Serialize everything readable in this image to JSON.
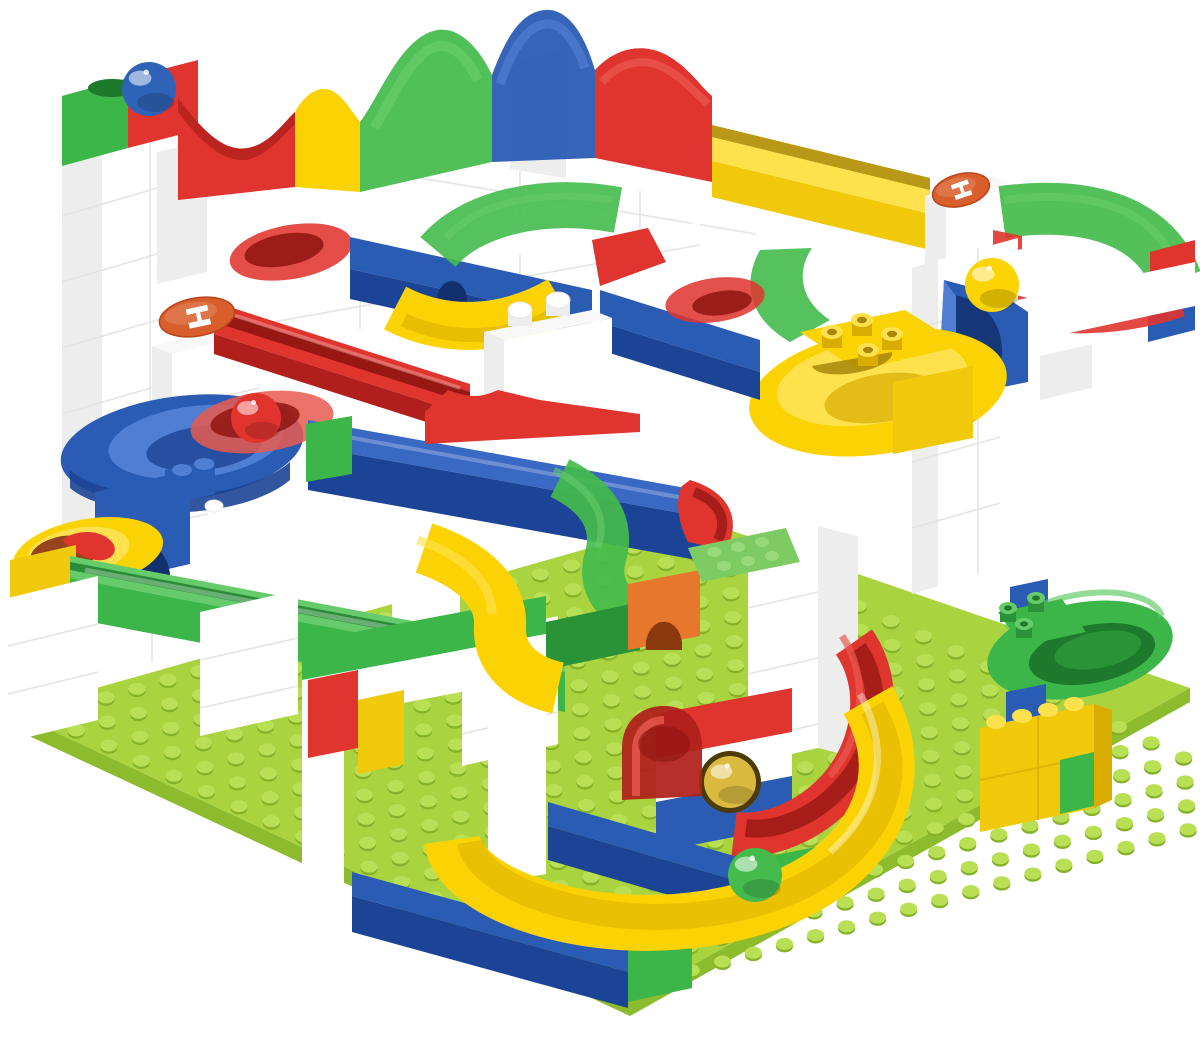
{
  "meta": {
    "alt": "Colorful marble run toy built from interlocking bricks on a lime-green baseplate, with red, blue, green and yellow chutes, white support towers and five marbles",
    "product_kind": "marble run construction set"
  },
  "brand": {
    "logo_letter": "H"
  },
  "palette": {
    "bg": "#ffffff",
    "white": "#ffffff",
    "white_side": "#ededed",
    "white_top": "#f8f8f8",
    "white_deep": "#dcdcdc",
    "seam": "#e4e4e4",
    "red": "#e0342f",
    "red_dark": "#b01f1b",
    "red_deep": "#8f1510",
    "red_trans": "#e85a50",
    "blue": "#2b5cb4",
    "blue_mid": "#3a69c4",
    "blue_dark": "#1c4496",
    "blue_deep": "#122f6e",
    "blue_light": "#4f7ed2",
    "green": "#3cb649",
    "green_mid": "#44bb4b",
    "green_dark": "#2a9338",
    "green_deep": "#1d7a2c",
    "green_light": "#66cc6b",
    "yellow": "#fbd304",
    "yellow_mid": "#f0c90a",
    "yellow_dark": "#d9ad00",
    "yellow_deep": "#a8850a",
    "yellow_light": "#ffe14d",
    "lime": "#a9d440",
    "lime_dark": "#8cbb2e",
    "lime_stud": "#b9df55",
    "lime_stud_dark": "#86b22a",
    "lightgreen_plate": "#7fcb63",
    "lightgreen_stud": "#97da79",
    "orange": "#e8772e",
    "orange_dark": "#8a3a0d",
    "logo": "#d85f2b",
    "logo_rim": "#b8441a"
  },
  "baseplate": {
    "color": "#a9d440",
    "stud_rows": 19,
    "stud_cols": 22
  },
  "marbles": [
    {
      "id": "marble-blue",
      "color": "#2f63b8",
      "cx": 149,
      "cy": 89,
      "r": 27,
      "layer": "front"
    },
    {
      "id": "marble-red",
      "color": "#e2342e",
      "cx": 256,
      "cy": 418,
      "r": 25,
      "layer": "front"
    },
    {
      "id": "marble-yellow",
      "color": "#fcd303",
      "cx": 992,
      "cy": 285,
      "r": 27,
      "layer": "front"
    },
    {
      "id": "marble-green",
      "color": "#45bb4e",
      "cx": 755,
      "cy": 875,
      "r": 27,
      "layer": "front"
    },
    {
      "id": "marble-yellow-hole",
      "color": "#d9ba3e",
      "cx": 730,
      "cy": 782,
      "r": 26,
      "layer": "hole"
    }
  ],
  "logos": [
    {
      "id": "logo-left",
      "cx": 197,
      "cy": 317,
      "rx": 38,
      "ry": 19,
      "tilt": -10,
      "letter_rotate": 88,
      "font": 30
    },
    {
      "id": "logo-right",
      "cx": 961,
      "cy": 190,
      "rx": 29,
      "ry": 16,
      "tilt": -14,
      "letter_rotate": 85,
      "font": 24
    }
  ]
}
